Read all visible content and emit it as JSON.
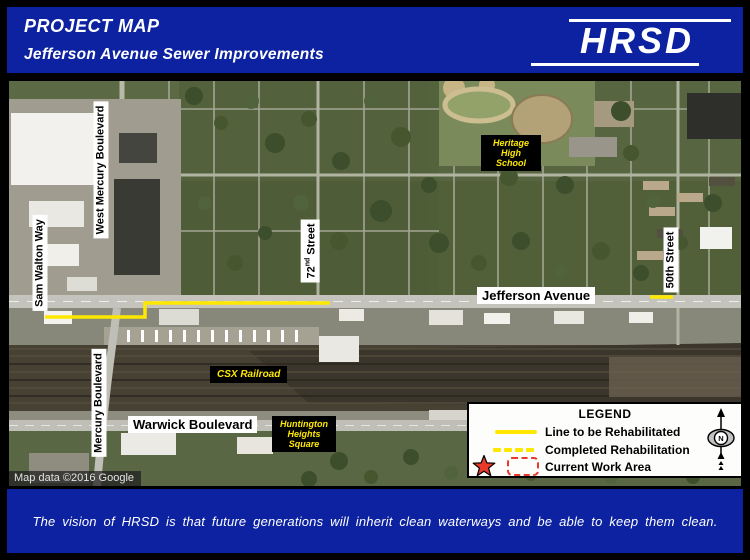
{
  "header": {
    "title": "PROJECT MAP",
    "subtitle": "Jefferson Avenue Sewer Improvements",
    "logo": "HRSD"
  },
  "map": {
    "attribution": "Map data ©2016 Google",
    "labels": {
      "sam_walton": "Sam Walton Way",
      "west_mercury": "West Mercury Boulevard",
      "mercury": "Mercury Boulevard",
      "street72": {
        "num": "72",
        "sup": "nd",
        "rest": "Street"
      },
      "street50": "50th Street",
      "jefferson": "Jefferson Avenue",
      "warwick": "Warwick Boulevard",
      "csx": "CSX Railroad",
      "heritage": [
        "Heritage",
        "High",
        "School"
      ],
      "huntington": [
        "Huntington",
        "Heights",
        "Square"
      ]
    }
  },
  "legend": {
    "title": "LEGEND",
    "items": [
      {
        "swatch": "solid-yellow-line",
        "label": "Line to be Rehabilitated"
      },
      {
        "swatch": "dashed-yellow-line",
        "label": "Completed Rehabilitation"
      },
      {
        "swatch": "red-star-and-dashed-box",
        "label": "Current Work Area"
      }
    ],
    "compass": {
      "letter": "N"
    }
  },
  "footer": {
    "tagline": "The vision  of HRSD is  that future generations  will inherit  clean waterways and be able  to keep them clean."
  },
  "colors": {
    "banner_blue": "#0c22a0",
    "rehab_line_yellow": "#ffe800",
    "work_area_red": "#e8392a",
    "place_label_yellow": "#ffe800"
  }
}
